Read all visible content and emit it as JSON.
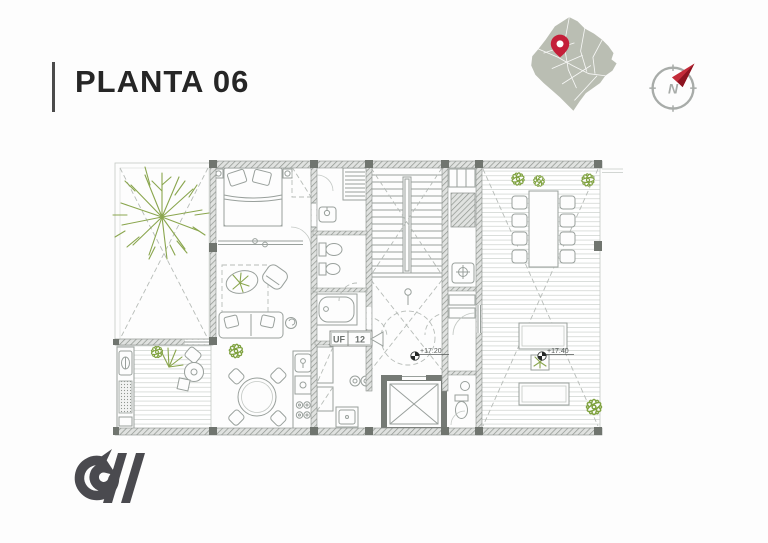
{
  "header": {
    "title": "PLANTA 06"
  },
  "compass": {
    "north_label": "N"
  },
  "plan": {
    "unit_label": {
      "left": "UF",
      "right": "12"
    },
    "levels": [
      {
        "text": "+17.20"
      },
      {
        "text": "+17.40"
      }
    ]
  },
  "icons": {
    "map_pin": "location-pin-icon",
    "compass": "compass-north-icon",
    "logo": "cv-monogram-logo"
  },
  "colors": {
    "accent_red": "#c41f39",
    "plant_green": "#8aa64e",
    "wall_gray": "#8f948f",
    "map_gray": "#babeb3",
    "title_ink": "#262626",
    "logo_ink": "#4a4a4f"
  }
}
